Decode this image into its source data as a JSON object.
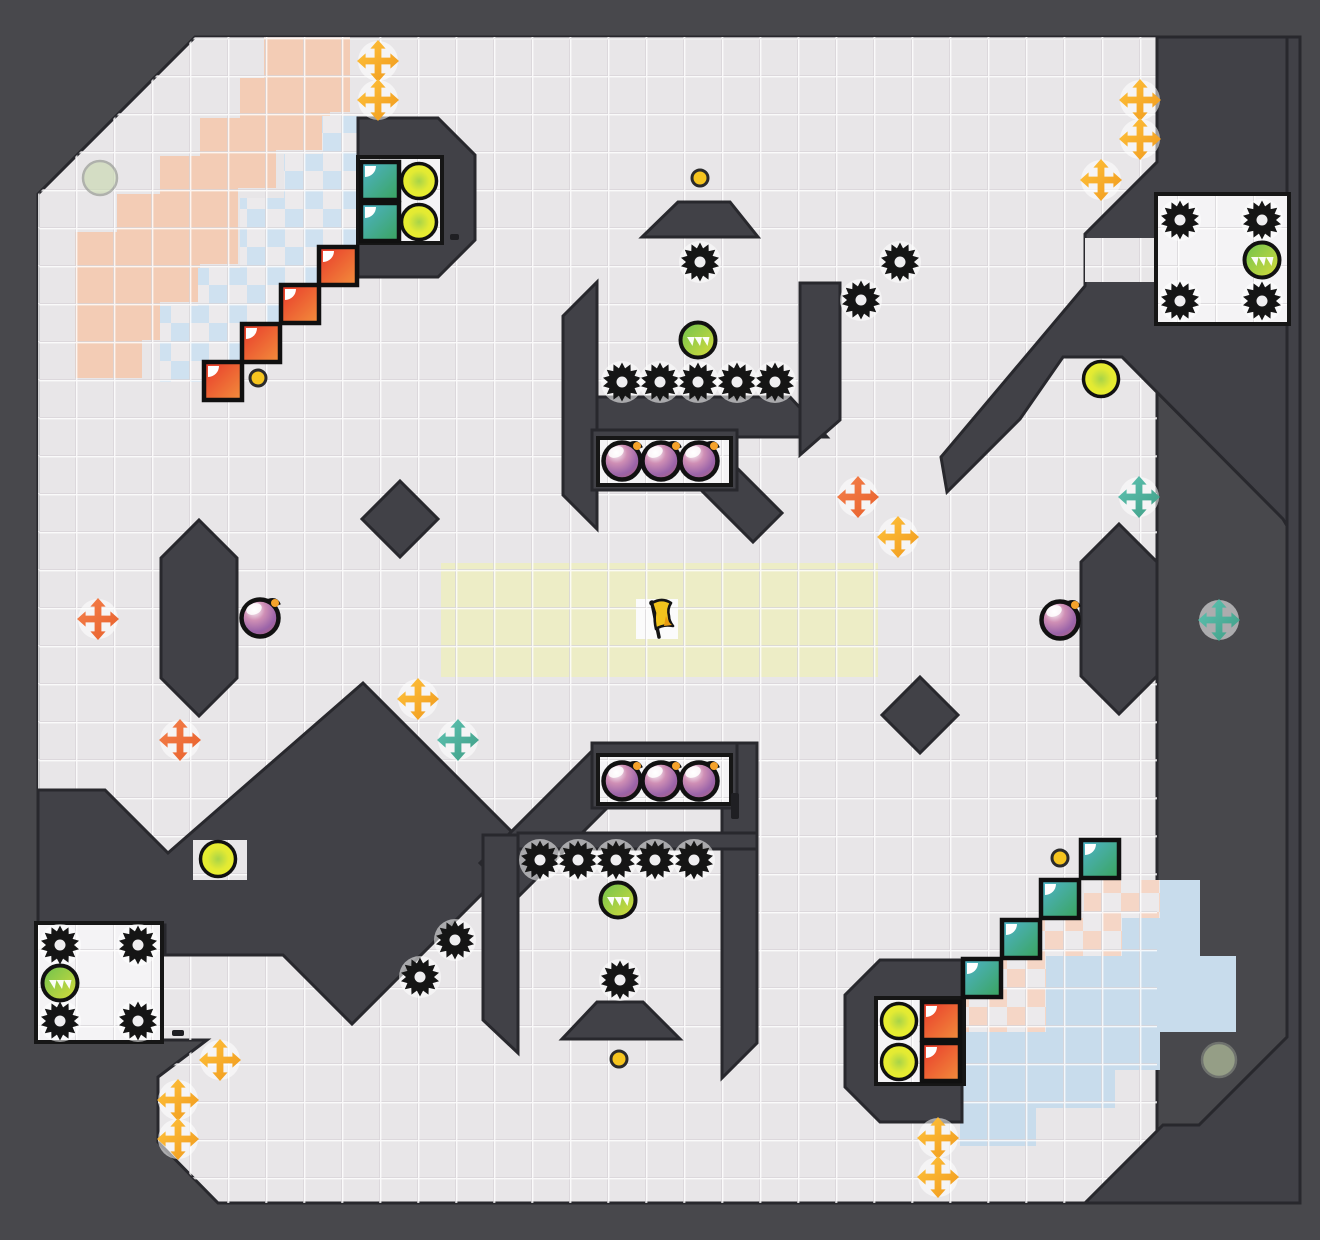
{
  "scene": {
    "width": 1320,
    "height": 1240,
    "colors": {
      "backdrop": "#48484c",
      "wall_fill": "#414147",
      "wall_stroke": "#28282d",
      "floor": "#e8e6e8",
      "floor_line_dark": "#d7d4d8",
      "floor_line_light": "rgba(255,255,255,0.8)",
      "inset_white": "#f4f3f5",
      "inset_stroke": "#161616",
      "salmon": "#f3ccb5",
      "checker_blue": "#cfe1f0",
      "checker_pink": "#f5d6c6",
      "checker_alt": "#eceaec",
      "solid_blue": "#c8dcec",
      "yellow_zone": "#ededc6",
      "flag_tile": "#fbfbfb",
      "gear": "#151515",
      "gear_hole": "#efeef0",
      "halo": "rgba(255,255,255,0.55)",
      "bomb_outline": "#111111",
      "bomb_spark": "#f5a22b",
      "dot_fill": "#f6c51f",
      "dot_ring": "#2b2b2b",
      "pale_orb": "#c8d8ad",
      "pale_orb_ring": "#8a8f85",
      "cross_yellow": [
        "#ffc43d",
        "#f0981c"
      ],
      "cross_orange": [
        "#f4824d",
        "#e85f2a"
      ],
      "cross_teal": [
        "#5fc4b4",
        "#3f9d84"
      ],
      "tile_red": [
        "#e8382b",
        "#f28f3c"
      ],
      "tile_teal": [
        "#4fb3cd",
        "#3aa45c"
      ],
      "orb_green": [
        "#6cc24f",
        "#d9dc3a"
      ],
      "orb_yellow": [
        "#a8d448",
        "#eaef2c"
      ],
      "bomb_body": [
        "#ffffff",
        "#cf8fb5",
        "#9a63a8",
        "#b75f63"
      ],
      "flag_yellow": "#f2c41d",
      "flag_stroke": "#141414",
      "slit": "#1f1f23"
    }
  },
  "map": {
    "field_points": "195,37 1157,37 1157,1203 1085,1203 218,1203 158,1142 158,1077 207,1040 38,1040 38,194",
    "field_points_note": "main floor region; top-right mass overlays it",
    "walls": [
      {
        "name": "wall-top-right-mass",
        "points": "1157,37 1300,37 1300,548 1283,519 1122,357 1063,357 1020,419 947,492 941,457 1085,286 1085,234 1122,197 1157,162"
      },
      {
        "name": "wall-bottom-right-corner",
        "points": "1157,37 1300,37 1300,1203 1085,1203 1163,1125 1199,1125 1287,1037 1287,37"
      },
      {
        "name": "wall-left-wedge",
        "points": "363,683 528,848 352,1024 283,955 165,955 165,925 38,925 38,790 105,790 168,853"
      },
      {
        "name": "wall-top-left-blob",
        "points": "358,118 438,118 475,155 475,240 438,277 358,277"
      },
      {
        "name": "wall-bottom-right-blob",
        "points": "880,960 962,960 962,1122 880,1122 845,1087 845,995"
      },
      {
        "name": "wall-top-trapezoid",
        "points": "678,202 730,202 758,237 642,237"
      },
      {
        "name": "wall-bottom-trapezoid",
        "points": "597,1002 643,1002 680,1039 562,1039"
      },
      {
        "name": "wall-left-pillar",
        "points": "199,520 237,558 237,678 199,716 161,678 161,558"
      },
      {
        "name": "wall-right-pillar",
        "points": "1119,524 1157,562 1157,676 1119,714 1081,676 1081,562"
      },
      {
        "name": "wall-left-diamond",
        "points": "400,481 438,519 400,557 362,519"
      },
      {
        "name": "wall-right-diamond",
        "points": "920,677 958,715 920,753 882,715"
      },
      {
        "name": "wall-t-left-slab",
        "points": "563,316 597,282 597,529 563,495"
      },
      {
        "name": "wall-t-shelf",
        "points": "597,397 790,397 827,437 597,437"
      },
      {
        "name": "wall-t-right-limb",
        "points": "800,283 840,283 840,420 800,455"
      },
      {
        "name": "wall-t-tail",
        "points": "729,460 782,513 753,542 700,489"
      },
      {
        "name": "wall-s-wing",
        "points": "480,863 598,745 634,781 516,899"
      },
      {
        "name": "wall-s-right-wall",
        "points": "722,743 757,743 757,1043 722,1078"
      },
      {
        "name": "wall-s-shelf",
        "points": "518,833 757,833 757,849 518,849"
      },
      {
        "name": "wall-s-left-wall",
        "points": "483,835 518,835 518,1053 483,1020"
      }
    ],
    "wall_rects": [
      {
        "name": "wall-bomb-frame-top",
        "x": 592,
        "y": 430,
        "w": 145,
        "h": 60
      },
      {
        "name": "wall-bomb-frame-bottom",
        "x": 592,
        "y": 743,
        "w": 145,
        "h": 65
      }
    ],
    "light_patches": [
      {
        "name": "orb-pocket",
        "x": 193,
        "y": 840,
        "w": 54,
        "h": 40
      },
      {
        "name": "gearbox-mouth",
        "x": 1085,
        "y": 238,
        "w": 73,
        "h": 44
      }
    ],
    "insets": [
      {
        "name": "inset-top-left-box",
        "x": 360,
        "y": 159,
        "w": 80,
        "h": 82,
        "stroke": true
      },
      {
        "name": "inset-bottom-right-box",
        "x": 878,
        "y": 1000,
        "w": 84,
        "h": 82,
        "stroke": true
      },
      {
        "name": "inset-top-bombs",
        "x": 600,
        "y": 440,
        "w": 129,
        "h": 43,
        "stroke": true
      },
      {
        "name": "inset-bottom-bombs",
        "x": 600,
        "y": 757,
        "w": 129,
        "h": 45,
        "stroke": true
      },
      {
        "name": "inset-top-right-gearbox",
        "x": 1158,
        "y": 196,
        "w": 129,
        "h": 126,
        "stroke": true
      },
      {
        "name": "inset-bottom-left-gearbox",
        "x": 38,
        "y": 925,
        "w": 122,
        "h": 115,
        "stroke": true
      }
    ],
    "zones": {
      "salmon_points": "264,37 350,37 350,112 330,112 330,150 276,150 276,188 238,188 238,264 200,264 200,302 160,302 160,340 142,340 142,378 75,378 75,232 117,232 117,194 160,194 160,156 200,156 200,118 240,118 240,78 264,78",
      "checker_blue_blocks": [
        [
          322,
          116,
          36,
          40
        ],
        [
          284,
          154,
          74,
          46
        ],
        [
          240,
          198,
          118,
          70
        ],
        [
          198,
          268,
          122,
          38
        ],
        [
          160,
          306,
          122,
          38
        ],
        [
          160,
          344,
          84,
          38
        ]
      ],
      "checker_pink_blocks": [
        [
          1084,
          880,
          76,
          38
        ],
        [
          1040,
          918,
          82,
          38
        ],
        [
          1002,
          956,
          82,
          38
        ],
        [
          964,
          994,
          82,
          38
        ],
        [
          962,
          1032,
          46,
          76
        ]
      ],
      "solid_blue_blocks": [
        [
          1160,
          880,
          40,
          38
        ],
        [
          1122,
          918,
          78,
          76
        ],
        [
          1046,
          956,
          190,
          76
        ],
        [
          960,
          1032,
          200,
          38
        ],
        [
          960,
          1070,
          155,
          38
        ],
        [
          960,
          1108,
          76,
          38
        ]
      ],
      "yellow_zone": {
        "x": 441,
        "y": 563,
        "w": 437,
        "h": 114
      },
      "flag_tile": {
        "x": 636,
        "y": 599,
        "w": 42,
        "h": 40
      }
    },
    "slits": [
      {
        "x": 450,
        "y": 234,
        "w": 9,
        "h": 6
      },
      {
        "x": 731,
        "y": 793,
        "w": 8,
        "h": 26
      },
      {
        "x": 172,
        "y": 1030,
        "w": 12,
        "h": 6
      }
    ]
  },
  "objects": {
    "gears": [
      [
        700,
        262
      ],
      [
        622,
        382
      ],
      [
        660,
        382
      ],
      [
        698,
        382
      ],
      [
        737,
        382
      ],
      [
        775,
        382
      ],
      [
        900,
        262
      ],
      [
        861,
        300
      ],
      [
        1180,
        220
      ],
      [
        1262,
        220
      ],
      [
        1180,
        301
      ],
      [
        1262,
        301
      ],
      [
        540,
        860
      ],
      [
        578,
        860
      ],
      [
        616,
        860
      ],
      [
        655,
        860
      ],
      [
        694,
        860
      ],
      [
        620,
        980
      ],
      [
        455,
        940
      ],
      [
        420,
        977
      ],
      [
        60,
        945
      ],
      [
        138,
        945
      ],
      [
        60,
        1021
      ],
      [
        138,
        1021
      ]
    ],
    "bombs": [
      [
        622,
        461
      ],
      [
        661,
        461
      ],
      [
        699,
        461
      ],
      [
        622,
        781
      ],
      [
        661,
        781
      ],
      [
        699,
        781
      ],
      [
        260,
        618
      ],
      [
        1060,
        620
      ]
    ],
    "green_orbs": [
      [
        698,
        340
      ],
      [
        1262,
        260
      ],
      [
        618,
        900
      ],
      [
        60,
        983
      ]
    ],
    "yellow_orbs": [
      [
        419,
        181
      ],
      [
        419,
        222
      ],
      [
        1101,
        379
      ],
      [
        218,
        859
      ],
      [
        899,
        1021
      ],
      [
        899,
        1062
      ]
    ],
    "pale_orbs": [
      [
        100,
        178
      ],
      [
        1219,
        1060
      ]
    ],
    "dots": [
      [
        258,
        378
      ],
      [
        700,
        178
      ],
      [
        619,
        1059
      ],
      [
        1060,
        858
      ]
    ],
    "crosses": [
      {
        "x": 378,
        "y": 61,
        "c": "yellow"
      },
      {
        "x": 378,
        "y": 100,
        "c": "yellow"
      },
      {
        "x": 1140,
        "y": 100,
        "c": "yellow"
      },
      {
        "x": 1140,
        "y": 139,
        "c": "yellow"
      },
      {
        "x": 1101,
        "y": 180,
        "c": "yellow"
      },
      {
        "x": 898,
        "y": 537,
        "c": "yellow"
      },
      {
        "x": 418,
        "y": 699,
        "c": "yellow"
      },
      {
        "x": 220,
        "y": 1060,
        "c": "yellow"
      },
      {
        "x": 178,
        "y": 1100,
        "c": "yellow"
      },
      {
        "x": 178,
        "y": 1139,
        "c": "yellow"
      },
      {
        "x": 938,
        "y": 1138,
        "c": "yellow"
      },
      {
        "x": 938,
        "y": 1177,
        "c": "yellow"
      },
      {
        "x": 98,
        "y": 619,
        "c": "orange"
      },
      {
        "x": 858,
        "y": 497,
        "c": "orange"
      },
      {
        "x": 180,
        "y": 740,
        "c": "orange"
      },
      {
        "x": 1139,
        "y": 497,
        "c": "teal"
      },
      {
        "x": 1219,
        "y": 620,
        "c": "teal"
      },
      {
        "x": 458,
        "y": 740,
        "c": "teal"
      }
    ],
    "switch_tiles": [
      {
        "x": 361,
        "y": 162,
        "t": "teal"
      },
      {
        "x": 361,
        "y": 203,
        "t": "teal"
      },
      {
        "x": 1081,
        "y": 840,
        "t": "teal"
      },
      {
        "x": 1041,
        "y": 880,
        "t": "teal"
      },
      {
        "x": 1002,
        "y": 920,
        "t": "teal"
      },
      {
        "x": 963,
        "y": 959,
        "t": "teal"
      },
      {
        "x": 319,
        "y": 247,
        "t": "red"
      },
      {
        "x": 281,
        "y": 285,
        "t": "red"
      },
      {
        "x": 242,
        "y": 324,
        "t": "red"
      },
      {
        "x": 204,
        "y": 362,
        "t": "red"
      },
      {
        "x": 922,
        "y": 1002,
        "t": "red"
      },
      {
        "x": 922,
        "y": 1043,
        "t": "red"
      }
    ],
    "flags": [
      {
        "x": 656,
        "y": 618,
        "c": "yellow"
      }
    ]
  }
}
